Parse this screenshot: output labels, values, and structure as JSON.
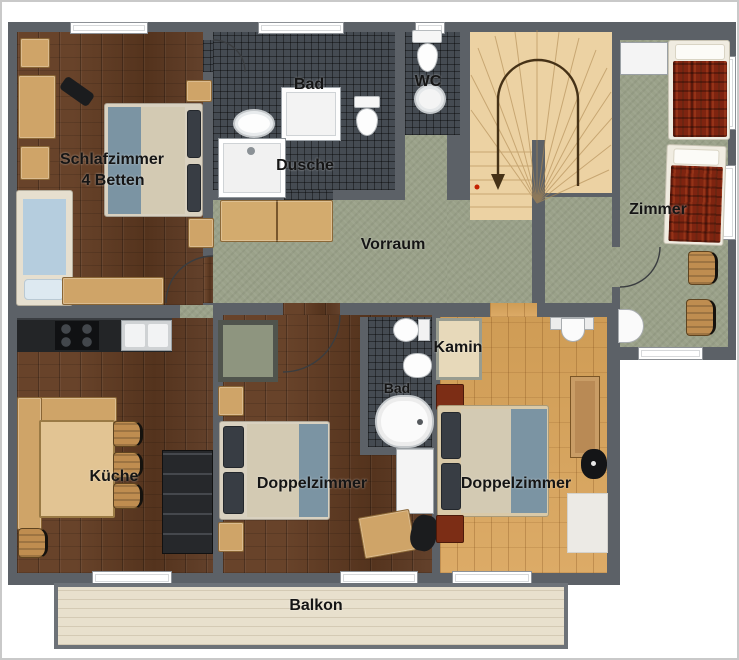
{
  "plan": {
    "title": "apartment-floor-plan",
    "labels": {
      "schlafzimmer": "Schlafzimmer",
      "schlafzimmer_sub": "4 Betten",
      "bad_top": "Bad",
      "dusche": "Dusche",
      "wc": "WC",
      "vorraum": "Vorraum",
      "zimmer": "Zimmer",
      "kueche": "Küche",
      "doppelzimmer_mid": "Doppelzimmer",
      "kamin": "Kamin",
      "bad_mid": "Bad",
      "doppelzimmer_right": "Doppelzimmer",
      "balkon": "Balkon"
    },
    "colors": {
      "wall": "#5c6167",
      "dark_wood_floor": "#5a3720",
      "light_wood_floor": "#d7a660",
      "green_floor": "#9aa189",
      "tile_floor": "#454b52",
      "stair_wood": "#ecd2a3",
      "balcony_floor": "#e8e0cd",
      "bed_red": "#7e2410",
      "bed_blue_mattress": "#b5cdde",
      "blanket_beige": "#d3cab3",
      "blanket_blue": "#7b94a3",
      "furniture_wood": "#cfa468",
      "kitchen_counter": "#232527",
      "fixture_white": "#f4f4f4",
      "kamin_beige": "#e7d9ba"
    }
  }
}
